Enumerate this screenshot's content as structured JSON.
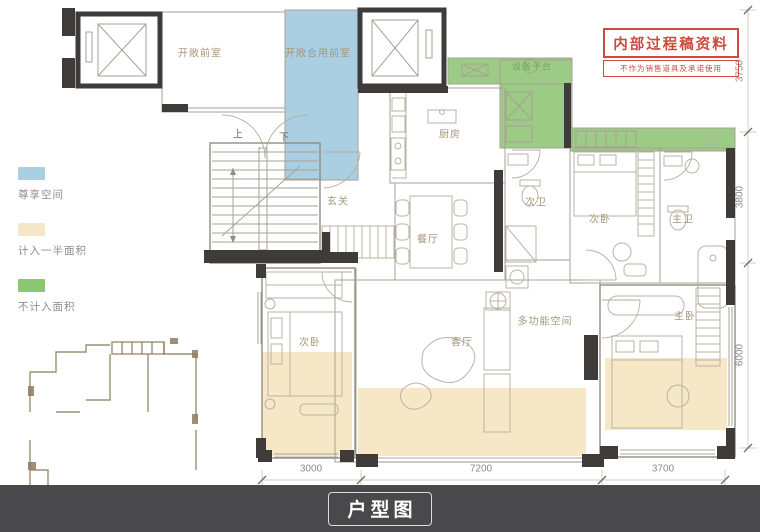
{
  "legend": {
    "items": [
      {
        "label": "尊享空间",
        "color": "#aacfe3"
      },
      {
        "label": "计入一半面积",
        "color": "#f6e8c6"
      },
      {
        "label": "不计入面积",
        "color": "#8bc874"
      }
    ]
  },
  "stamp": {
    "title": "内部过程稿资料",
    "subtitle": "不作为销售道具及承诺使用",
    "color": "#cd4a3e"
  },
  "rooms": [
    {
      "name": "开敞前室"
    },
    {
      "name": "开敞合用前室"
    },
    {
      "name": "玄关"
    },
    {
      "name": "厨房"
    },
    {
      "name": "设备平台"
    },
    {
      "name": "餐厅"
    },
    {
      "name": "次卫"
    },
    {
      "name": "次卧"
    },
    {
      "name": "主卫"
    },
    {
      "name": "客厅"
    },
    {
      "name": "多功能空间"
    },
    {
      "name": "次卧"
    },
    {
      "name": "主卧"
    }
  ],
  "stairs": {
    "up": "上",
    "down": "下"
  },
  "dimensions": {
    "bottom": [
      "3000",
      "7200",
      "3700"
    ],
    "right": [
      "3750",
      "3800",
      "6000"
    ]
  },
  "footer": {
    "title": "户型图",
    "background": "#49494b"
  }
}
